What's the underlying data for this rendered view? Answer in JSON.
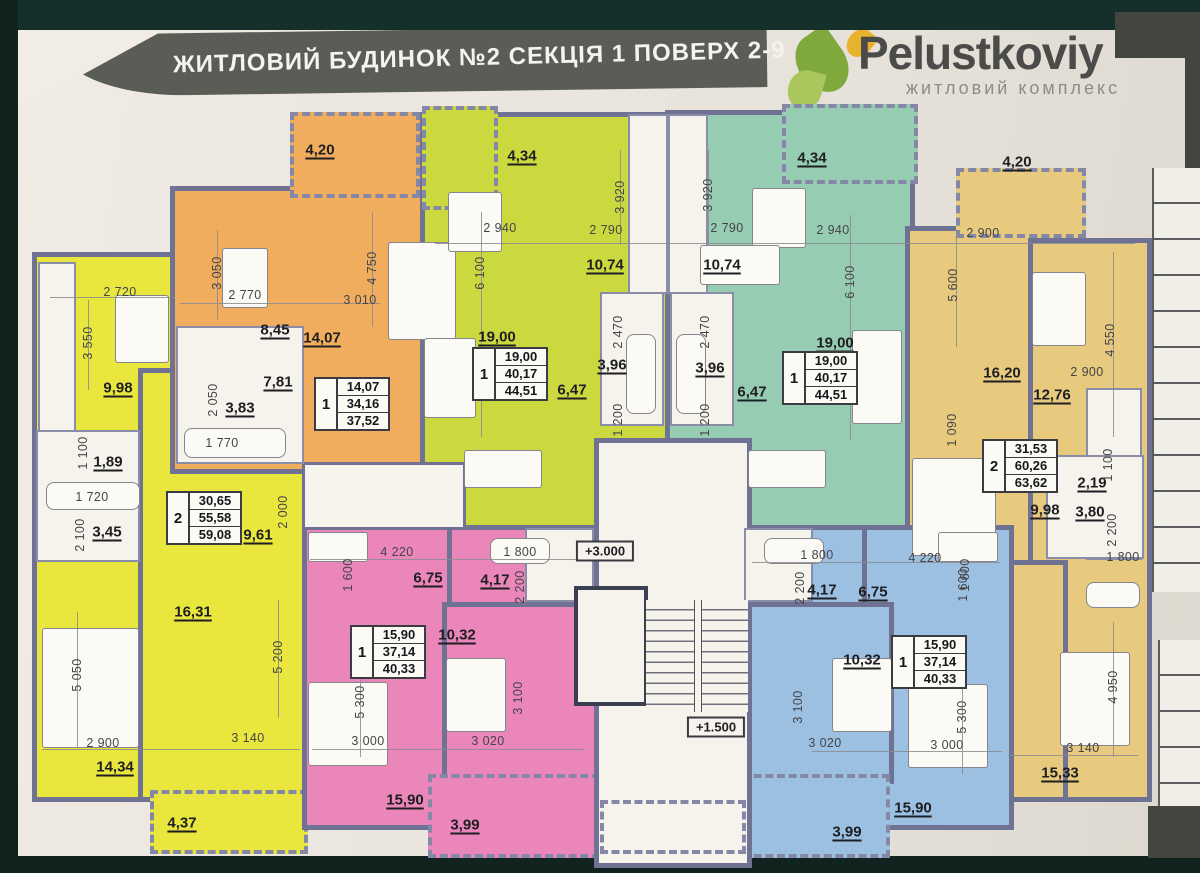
{
  "header": {
    "title": "ЖИТЛОВИЙ БУДИНОК №2  СЕКЦІЯ 1  ПОВЕРХ 2-9",
    "logo": {
      "name": "Pelustkoviy",
      "subtitle": "житловий комплекс"
    }
  },
  "colors": {
    "background": "#15302b",
    "paper": "#e8e4dc",
    "band": "#595d55",
    "wall": "#6f7292",
    "white": "#f6f3ec",
    "yellow": "#e9e73e",
    "orange": "#f0ad5e",
    "lime": "#ccd93e",
    "teal": "#96ccb2",
    "tan": "#e7ca7e",
    "pink": "#ea86ba",
    "blue": "#9cc0e2",
    "leaf": "#7fa83d",
    "leaf_light": "#a9c75c",
    "petal": "#e7b22c",
    "logo_text": "#4b4b49",
    "dark_block": "#43463f"
  },
  "plan": {
    "apartments": [
      {
        "id": "yellow-2room",
        "palette": "yellow",
        "info_table": {
          "x": 204,
          "y": 518,
          "rooms": "2",
          "values": [
            "30,65",
            "55,58",
            "59,08"
          ]
        },
        "areas": [
          {
            "t": "9,98",
            "x": 118,
            "y": 388
          },
          {
            "t": "1,89",
            "x": 108,
            "y": 462
          },
          {
            "t": "3,45",
            "x": 107,
            "y": 532
          },
          {
            "t": "9,61",
            "x": 258,
            "y": 535
          },
          {
            "t": "16,31",
            "x": 193,
            "y": 612
          },
          {
            "t": "14,34",
            "x": 115,
            "y": 767
          },
          {
            "t": "4,37",
            "x": 182,
            "y": 823
          }
        ],
        "dims": [
          {
            "t": "2 720",
            "x": 120,
            "y": 292
          },
          {
            "t": "3 550",
            "x": 88,
            "y": 343,
            "r": 1
          },
          {
            "t": "1 100",
            "x": 83,
            "y": 453,
            "r": 1
          },
          {
            "t": "1 720",
            "x": 92,
            "y": 497
          },
          {
            "t": "2 100",
            "x": 80,
            "y": 535,
            "r": 1
          },
          {
            "t": "2 000",
            "x": 283,
            "y": 512,
            "r": 1
          },
          {
            "t": "5 050",
            "x": 77,
            "y": 675,
            "r": 1
          },
          {
            "t": "5 200",
            "x": 278,
            "y": 657,
            "r": 1
          },
          {
            "t": "2 900",
            "x": 103,
            "y": 743
          },
          {
            "t": "3 140",
            "x": 248,
            "y": 738
          }
        ]
      },
      {
        "id": "orange-1room",
        "palette": "orange",
        "info_table": {
          "x": 352,
          "y": 404,
          "rooms": "1",
          "values": [
            "14,07",
            "34,16",
            "37,52"
          ]
        },
        "areas": [
          {
            "t": "4,20",
            "x": 320,
            "y": 150
          },
          {
            "t": "8,45",
            "x": 275,
            "y": 330
          },
          {
            "t": "14,07",
            "x": 322,
            "y": 338
          },
          {
            "t": "7,81",
            "x": 278,
            "y": 382
          },
          {
            "t": "3,83",
            "x": 240,
            "y": 408
          }
        ],
        "dims": [
          {
            "t": "3 050",
            "x": 217,
            "y": 273,
            "r": 1
          },
          {
            "t": "2 770",
            "x": 245,
            "y": 295
          },
          {
            "t": "4 750",
            "x": 372,
            "y": 268,
            "r": 1
          },
          {
            "t": "3 010",
            "x": 360,
            "y": 300
          },
          {
            "t": "2 050",
            "x": 213,
            "y": 400,
            "r": 1
          },
          {
            "t": "1 770",
            "x": 222,
            "y": 443
          }
        ]
      },
      {
        "id": "lime-1room",
        "palette": "lime",
        "info_table": {
          "x": 510,
          "y": 374,
          "rooms": "1",
          "values": [
            "19,00",
            "40,17",
            "44,51"
          ]
        },
        "areas": [
          {
            "t": "4,34",
            "x": 522,
            "y": 156
          },
          {
            "t": "19,00",
            "x": 497,
            "y": 337
          },
          {
            "t": "10,74",
            "x": 605,
            "y": 265
          },
          {
            "t": "3,96",
            "x": 612,
            "y": 365
          },
          {
            "t": "6,47",
            "x": 572,
            "y": 390
          }
        ],
        "dims": [
          {
            "t": "2 940",
            "x": 500,
            "y": 228
          },
          {
            "t": "6 100",
            "x": 480,
            "y": 273,
            "r": 1
          },
          {
            "t": "3 920",
            "x": 620,
            "y": 197,
            "r": 1
          },
          {
            "t": "2 790",
            "x": 606,
            "y": 230
          },
          {
            "t": "2 470",
            "x": 618,
            "y": 332,
            "r": 1
          },
          {
            "t": "1 200",
            "x": 618,
            "y": 420,
            "r": 1
          }
        ]
      },
      {
        "id": "teal-1room",
        "palette": "teal",
        "info_table": {
          "x": 820,
          "y": 378,
          "rooms": "1",
          "values": [
            "19,00",
            "40,17",
            "44,51"
          ]
        },
        "areas": [
          {
            "t": "4,34",
            "x": 812,
            "y": 158
          },
          {
            "t": "10,74",
            "x": 722,
            "y": 265
          },
          {
            "t": "3,96",
            "x": 710,
            "y": 368
          },
          {
            "t": "6,47",
            "x": 752,
            "y": 392
          },
          {
            "t": "19,00",
            "x": 835,
            "y": 343
          }
        ],
        "dims": [
          {
            "t": "3 920",
            "x": 708,
            "y": 195,
            "r": 1
          },
          {
            "t": "2 790",
            "x": 727,
            "y": 228
          },
          {
            "t": "2 940",
            "x": 833,
            "y": 230
          },
          {
            "t": "2 470",
            "x": 705,
            "y": 332,
            "r": 1
          },
          {
            "t": "1 200",
            "x": 705,
            "y": 420,
            "r": 1
          },
          {
            "t": "6 100",
            "x": 850,
            "y": 282,
            "r": 1
          }
        ]
      },
      {
        "id": "tan-2room",
        "palette": "tan",
        "info_table": {
          "x": 1020,
          "y": 466,
          "rooms": "2",
          "values": [
            "31,53",
            "60,26",
            "63,62"
          ]
        },
        "areas": [
          {
            "t": "4,20",
            "x": 1017,
            "y": 162
          },
          {
            "t": "16,20",
            "x": 1002,
            "y": 373
          },
          {
            "t": "12,76",
            "x": 1052,
            "y": 395
          },
          {
            "t": "2,19",
            "x": 1092,
            "y": 483
          },
          {
            "t": "9,98",
            "x": 1045,
            "y": 510
          },
          {
            "t": "3,80",
            "x": 1090,
            "y": 512
          },
          {
            "t": "15,33",
            "x": 1060,
            "y": 773
          }
        ],
        "dims": [
          {
            "t": "2 900",
            "x": 983,
            "y": 233
          },
          {
            "t": "5 600",
            "x": 953,
            "y": 285,
            "r": 1
          },
          {
            "t": "2 900",
            "x": 1087,
            "y": 372
          },
          {
            "t": "4 550",
            "x": 1110,
            "y": 340,
            "r": 1
          },
          {
            "t": "1 090",
            "x": 952,
            "y": 430,
            "r": 1
          },
          {
            "t": "1 100",
            "x": 1108,
            "y": 465,
            "r": 1
          },
          {
            "t": "2 200",
            "x": 1112,
            "y": 530,
            "r": 1
          },
          {
            "t": "1 800",
            "x": 1123,
            "y": 557
          },
          {
            "t": "1 600",
            "x": 965,
            "y": 575,
            "r": 1
          },
          {
            "t": "4 950",
            "x": 1113,
            "y": 687,
            "r": 1
          },
          {
            "t": "3 140",
            "x": 1083,
            "y": 748
          }
        ]
      },
      {
        "id": "pink-1room",
        "palette": "pink",
        "info_table": {
          "x": 388,
          "y": 652,
          "rooms": "1",
          "values": [
            "15,90",
            "37,14",
            "40,33"
          ]
        },
        "areas": [
          {
            "t": "6,75",
            "x": 428,
            "y": 578
          },
          {
            "t": "4,17",
            "x": 495,
            "y": 580
          },
          {
            "t": "10,32",
            "x": 457,
            "y": 635
          },
          {
            "t": "15,90",
            "x": 405,
            "y": 800
          },
          {
            "t": "3,99",
            "x": 465,
            "y": 825
          }
        ],
        "dims": [
          {
            "t": "4 220",
            "x": 397,
            "y": 552
          },
          {
            "t": "1 800",
            "x": 520,
            "y": 552
          },
          {
            "t": "1 600",
            "x": 348,
            "y": 575,
            "r": 1
          },
          {
            "t": "2 200",
            "x": 520,
            "y": 587,
            "r": 1
          },
          {
            "t": "5 300",
            "x": 360,
            "y": 702,
            "r": 1
          },
          {
            "t": "3 100",
            "x": 518,
            "y": 698,
            "r": 1
          },
          {
            "t": "3 000",
            "x": 368,
            "y": 741
          },
          {
            "t": "3 020",
            "x": 488,
            "y": 741
          }
        ]
      },
      {
        "id": "blue-1room",
        "palette": "blue",
        "info_table": {
          "x": 929,
          "y": 662,
          "rooms": "1",
          "values": [
            "15,90",
            "37,14",
            "40,33"
          ]
        },
        "areas": [
          {
            "t": "4,17",
            "x": 822,
            "y": 590
          },
          {
            "t": "6,75",
            "x": 873,
            "y": 592
          },
          {
            "t": "10,32",
            "x": 862,
            "y": 660
          },
          {
            "t": "15,90",
            "x": 913,
            "y": 808
          },
          {
            "t": "3,99",
            "x": 847,
            "y": 832
          }
        ],
        "dims": [
          {
            "t": "1 800",
            "x": 817,
            "y": 555
          },
          {
            "t": "4 220",
            "x": 925,
            "y": 558
          },
          {
            "t": "2 200",
            "x": 800,
            "y": 588,
            "r": 1
          },
          {
            "t": "1 600",
            "x": 963,
            "y": 585,
            "r": 1
          },
          {
            "t": "3 100",
            "x": 798,
            "y": 707,
            "r": 1
          },
          {
            "t": "5 300",
            "x": 962,
            "y": 717,
            "r": 1
          },
          {
            "t": "3 020",
            "x": 825,
            "y": 743
          },
          {
            "t": "3 000",
            "x": 947,
            "y": 745
          }
        ]
      }
    ],
    "stairwell": {
      "marks": [
        {
          "t": "+3.000",
          "x": 605,
          "y": 551
        },
        {
          "t": "+1.500",
          "x": 716,
          "y": 727
        }
      ]
    }
  }
}
